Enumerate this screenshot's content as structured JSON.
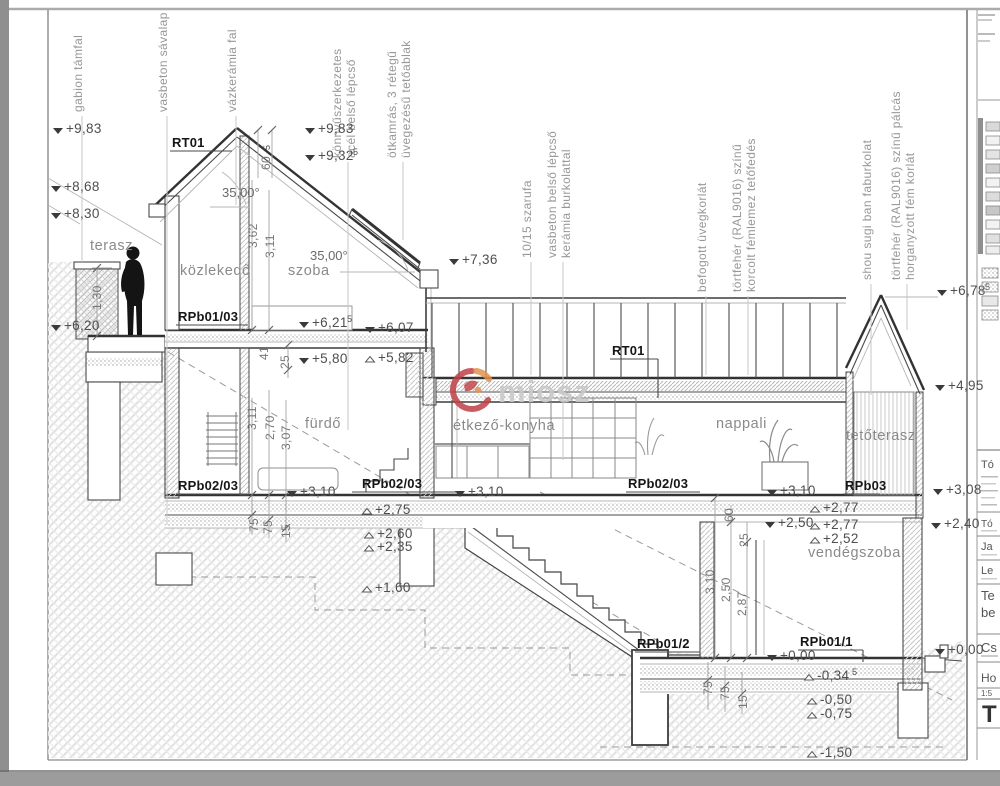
{
  "watermark": {
    "name": "miosz"
  },
  "top_labels": [
    {
      "l1": "gabion támfal",
      "l2": ""
    },
    {
      "l1": "vasbeton sávalap",
      "l2": ""
    },
    {
      "l1": "vázkerámia fal",
      "l2": ""
    },
    {
      "l1": "könnyűszerkezetes",
      "l2": "acél belső lépcső"
    },
    {
      "l1": "ötkamrás, 3 rétegű",
      "l2": "üvegezésű tetőablak"
    },
    {
      "l1": "10/15 szarufa",
      "l2": ""
    },
    {
      "l1": "vasbeton belső lépcső",
      "l2": "kerámia burkolattal"
    },
    {
      "l1": "befogott üvegkorlát",
      "l2": ""
    },
    {
      "l1": "törtfehér (RAL9016) színű",
      "l2": "korcolt fémlemez tetőfedés"
    },
    {
      "l1": "shou sugi ban faburkolat",
      "l2": ""
    },
    {
      "l1": "törtfehér (RAL9016) színű pálcás",
      "l2": "horganyzott fém korlát"
    }
  ],
  "rooms": {
    "terasz": "terasz",
    "kozlekedo": "közlekedő",
    "szoba": "szoba",
    "furdo": "fürdő",
    "etkezo": "étkező-konyha",
    "nappali": "nappali",
    "tetoterasz": "tetőterasz",
    "vendegszoba": "vendégszoba"
  },
  "refs": {
    "rt01_a": "RT01",
    "rt01_b": "RT01",
    "rpb0103": "RPb01/03",
    "rpb0203_a": "RPb02/03",
    "rpb0203_b": "RPb02/03",
    "rpb0203_c": "RPb02/03",
    "rpb03": "RPb03",
    "rpb012": "RPb01/2",
    "rpb011": "RPb01/1"
  },
  "levels": {
    "l983a": "+9,83",
    "l868": "+8,68",
    "l830": "+8,30",
    "l620": "+6,20",
    "l983b": "+9,83",
    "l932": "+9,32",
    "l932s": "5",
    "l736": "+7,36",
    "l6215": "+6,21",
    "l6215s": "5",
    "l607": "+6,07",
    "l580": "+5,80",
    "l582": "+5,82",
    "l678": "+6,78",
    "l678s": "5",
    "l495": "+4,95",
    "l308": "+3,08",
    "l240": "+2,40",
    "l310a": "+3,10",
    "l310b": "+3,10",
    "l310c": "+3,10",
    "l275": "+2,75",
    "l260": "+2,60",
    "l235": "+2,35",
    "l160": "+1,60",
    "l250": "+2,50",
    "l277a": "+2,77",
    "l277b": "+2,77",
    "l252": "+2,52",
    "l000": "+0,00",
    "l000r": "+0,00",
    "lm034": "-0,34",
    "lm034s": "5",
    "lm050": "-0,50",
    "lm075": "-0,75",
    "lm150": "-1,50"
  },
  "dims": {
    "d130": "1,30",
    "d362": "3,62",
    "d311a": "3,11",
    "d60r": "60",
    "d60rs": "5",
    "d41": "41",
    "d25a": "25",
    "d311b": "3,11",
    "d270": "2,70",
    "d307": "3,07",
    "d75a": "75",
    "d75b": "75",
    "d15a": "15",
    "d60": "60",
    "d25b": "25",
    "d310": "3,10",
    "d250": "2,50",
    "d287": "2,87",
    "d75c": "75",
    "d75d": "75",
    "d15b": "15"
  },
  "angles": {
    "a": "35,00°",
    "b": "35,00°"
  },
  "legend": {
    "e1": "Tó",
    "e2": "Tó",
    "e3": "Ja",
    "e4": "Le",
    "e5": "Te",
    "e6": "be",
    "e7": "Cs",
    "e8": "Ho",
    "e9": "1:5",
    "e10": "T"
  },
  "colors": {
    "logo_red": "#bf4044",
    "logo_orange": "#e0924f",
    "watermark_gray": "#c9c9c9"
  }
}
